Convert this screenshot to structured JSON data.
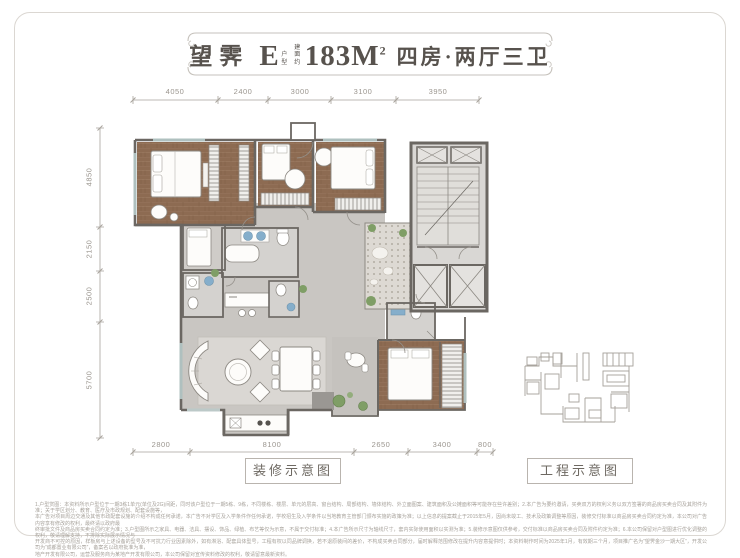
{
  "title": {
    "project_name": "望霁",
    "unit_letter": "E",
    "unit_label": "户型",
    "area_prefix": "建面约",
    "area_value": "183M",
    "area_sup": "2",
    "layout_desc": "四房·两厅三卫"
  },
  "dimensions": {
    "top": [
      "4050",
      "2400",
      "3000",
      "3100",
      "3950"
    ],
    "left": [
      "4850",
      "2150",
      "2500",
      "5700"
    ],
    "bottom": [
      "2800",
      "8100",
      "2650",
      "3400",
      "800"
    ]
  },
  "captions": {
    "decoration": "装修示意图",
    "engineering": "工程示意图"
  },
  "disclaimer": {
    "lines": [
      "1.户型赏图：本资料所示户型位于一期3栋1单元(单位及2G)间距，同时该户型位于一期5栋、9栋，不同楼栋、楼层、单元的层高、窗台结构、局部结构、墙体结构、外立面图案、建筑面积及公摊面积等可能存在些许差别；2.本广告为要约邀请，买卖双方的权利义务以双方签署的商品房买卖合同及其附件为准；关于学区划分、教育、医疗及市政规划、配套设施等，",
      "本广告对项目周边交通及其他市政配套设施的介绍不构成任何承诺，本广告不对学区及入学条件作任何承诺，学校招生及入学条件以当地教育主管部门颁布实施的政策为准；以上信息的提案截止于2015年5月，因尚未竣工、技术及政策调整等原因，装修交付标准以商品房买卖合同约定为准，本公司对广告内容享有修改的权利，最终请以政府最",
      "终审批文件及商品房买卖合同约定为准；3.户型图所示之家具、电器、洁具、摆设、饰品、绿植、布艺等仅为示意，不属于交付标准；4.本广告所示尺寸为轴线尺寸，套内实际使用面积以实测为准；5.装修示意图仅供参考，交付标准以商品房买卖合同及附件约定为准；6.本公司保留对户型图进行优化调整的权利，敬请理解支持，不排除实际展示情况与",
      "开发商不可控的原因，样板房与上述设备的型号及不可抗力行业因素除外，如有淋浴、配套具体型号，工程有权以同品牌调换，若不退原装间的差价，不构成买卖合同部分，届时解释范围修改在提升内容意提供时；本资料制作时间为2025年1月，有效期三个月，项目推广名为“望霁金沙一期大区”，开发公司为“成都置业有限公司”，备案名以政府批准为准，",
      "地产开发有限公司，运营及服务商为某地产开发有限公司，本公司保留对宣传资料修改的权利，敬请留意最新资料。"
    ]
  },
  "colors": {
    "title_text": "#57524d",
    "frame_line": "#c6c2bc",
    "wall": "#6b6762",
    "wood_floor": "#8d6b52",
    "tile_floor": "#c9c6c2",
    "fixture_blue": "#85aecb",
    "plant_green": "#7f9e66",
    "dim_text": "#9b968f"
  }
}
